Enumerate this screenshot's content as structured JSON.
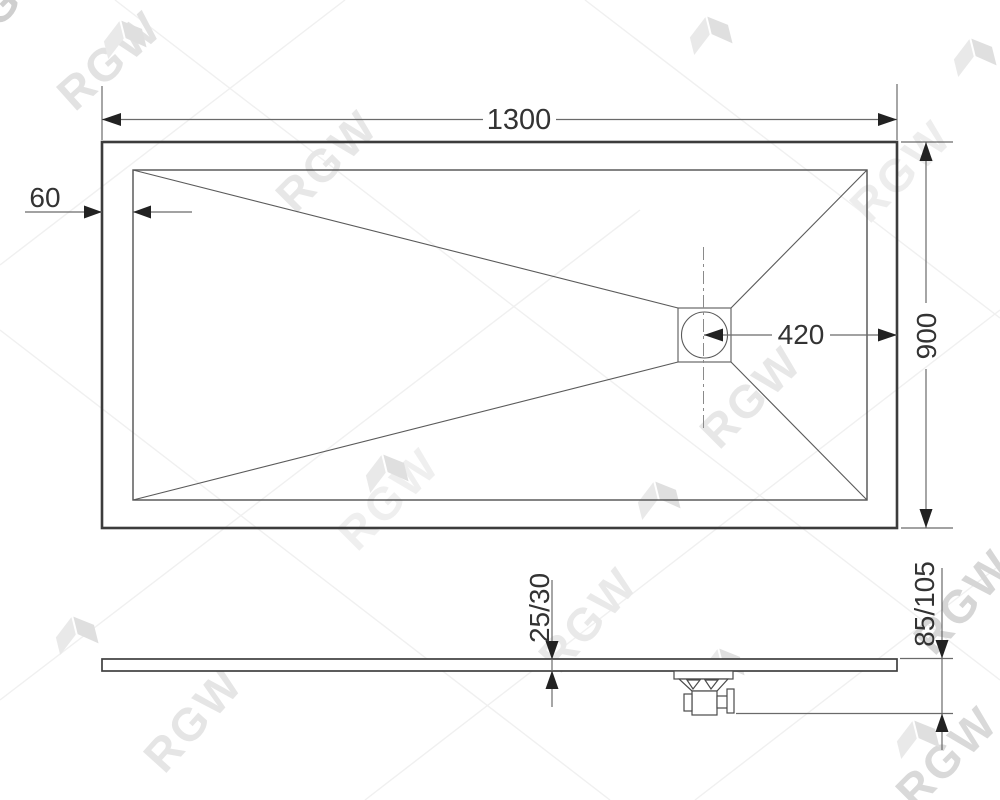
{
  "drawing": {
    "watermark_text": "RGW",
    "dims": {
      "length": "1300",
      "width": "900",
      "rim": "60",
      "drain_offset": "420",
      "thickness": "25/30",
      "total_height": "85/105"
    },
    "colors": {
      "line": "#3c3c3c",
      "dim_line": "#6a6a6a",
      "dim_text": "#333333",
      "watermark": "#e6e6e6"
    }
  }
}
